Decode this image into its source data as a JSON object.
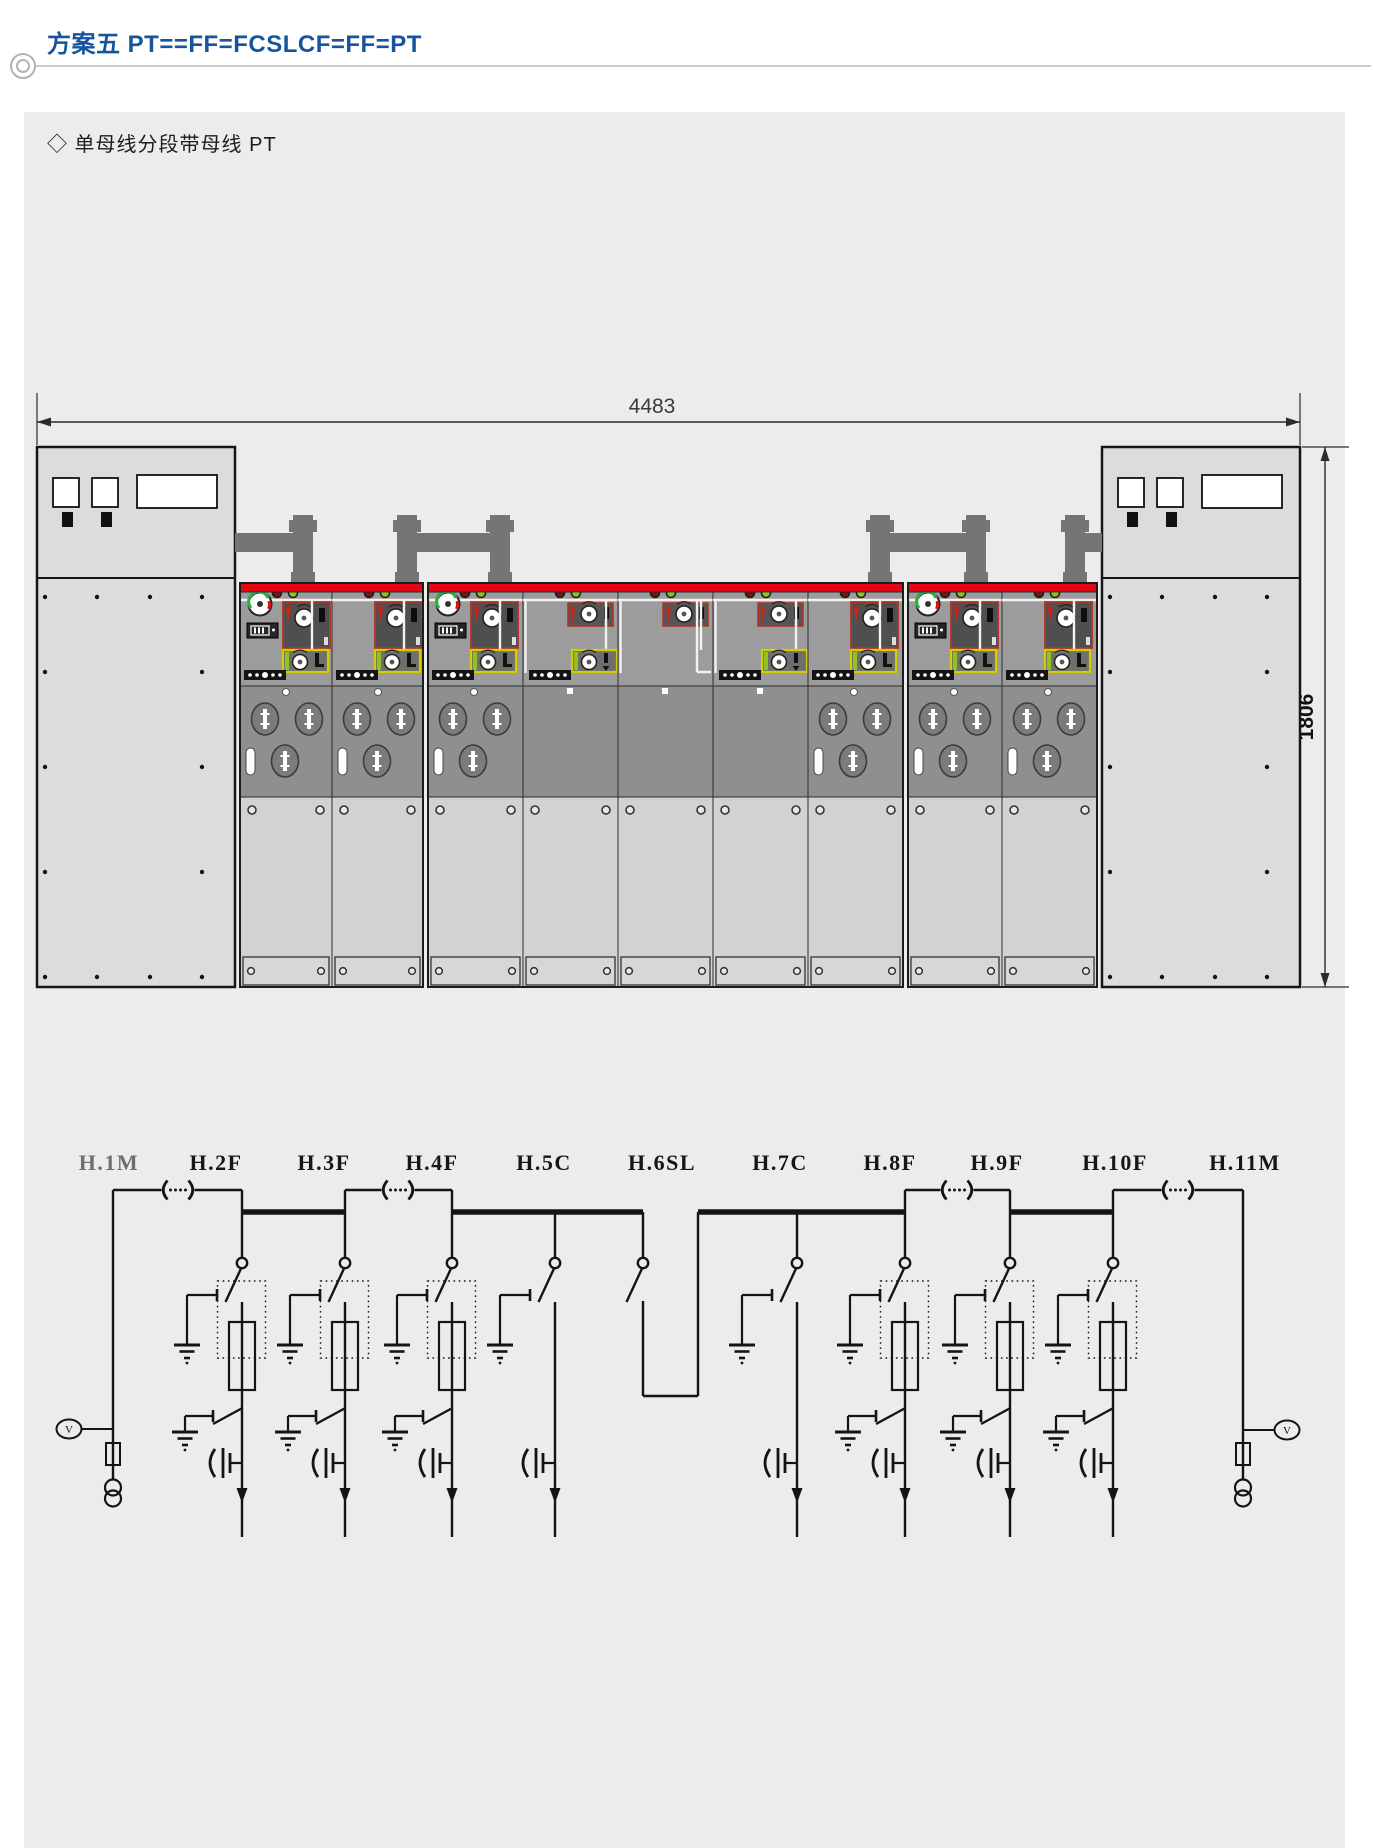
{
  "header": {
    "title": "方案五 PT==FF=FCSLCF=FF=PT"
  },
  "panel": {
    "subtitle": "◇ 单母线分段带母线 PT"
  },
  "colors": {
    "accent_blue": "#15559d",
    "red_stripe": "#e30613",
    "module_red_border": "#b23325",
    "yellow_border": "#d6cc00",
    "green_indicator": "#8fc31f",
    "panel_gray": "#9c9c9c",
    "line": "#1a1a1a",
    "pipe_gray": "#757575",
    "muted_label": "#6e6e6e"
  },
  "elevation": {
    "dim_width": "4483",
    "dim_height": "1806",
    "cabinets": [
      {
        "side": "left",
        "x": 37
      },
      {
        "side": "right",
        "x": 1102
      }
    ],
    "pipes": {
      "verticals": [
        303,
        407,
        500,
        880,
        976,
        1075
      ],
      "arms": [
        [
          235,
          304
        ],
        [
          407,
          501
        ],
        [
          880,
          977
        ],
        [
          1075,
          1102
        ]
      ]
    },
    "blocks": [
      {
        "x": 240,
        "panels": [
          {
            "feeder": "H.2F",
            "type": "F",
            "gauge": true,
            "w": 92
          },
          {
            "feeder": "H.3F",
            "type": "F",
            "gauge": false,
            "w": 91
          }
        ]
      },
      {
        "x": 428,
        "panels": [
          {
            "feeder": "H.4F",
            "type": "F",
            "gauge": true,
            "w": 95
          },
          {
            "feeder": "H.5C",
            "type": "C",
            "gauge": false,
            "w": 95
          },
          {
            "feeder": "H.6SL",
            "type": "SL",
            "gauge": false,
            "w": 95
          },
          {
            "feeder": "H.7C",
            "type": "C",
            "gauge": false,
            "w": 95
          },
          {
            "feeder": "H.8F",
            "type": "F",
            "gauge": false,
            "w": 95
          }
        ]
      },
      {
        "x": 908,
        "panels": [
          {
            "feeder": "H.9F",
            "type": "F",
            "gauge": true,
            "w": 94
          },
          {
            "feeder": "H.10F",
            "type": "F",
            "gauge": false,
            "w": 95
          }
        ]
      }
    ]
  },
  "schematic": {
    "meter_label": "V",
    "bus": {
      "thin": [
        {
          "x1": 113,
          "x2": 242,
          "cx": 178
        },
        {
          "x1": 345,
          "x2": 452,
          "cx": 398
        },
        {
          "x1": 905,
          "x2": 1010,
          "cx": 957
        },
        {
          "x1": 1113,
          "x2": 1243,
          "cx": 1178
        }
      ],
      "thick": [
        [
          242,
          345
        ],
        [
          452,
          643
        ],
        [
          698,
          905
        ],
        [
          1010,
          1113
        ]
      ],
      "sl_riser_x": 698
    },
    "feeders": [
      {
        "id": "H.1M",
        "type": "M",
        "x": 113,
        "label_x": 109,
        "muted": true,
        "side": "left"
      },
      {
        "id": "H.2F",
        "type": "F",
        "x": 242,
        "label_x": 216,
        "top": 1190
      },
      {
        "id": "H.3F",
        "type": "F",
        "x": 345,
        "label_x": 324,
        "top": 1190
      },
      {
        "id": "H.4F",
        "type": "F",
        "x": 452,
        "label_x": 432,
        "top": 1190
      },
      {
        "id": "H.5C",
        "type": "C",
        "x": 555,
        "label_x": 544,
        "top": 1212
      },
      {
        "id": "H.6SL",
        "type": "SL",
        "x": 643,
        "label_x": 662,
        "top": 1212
      },
      {
        "id": "H.7C",
        "type": "C",
        "x": 797,
        "label_x": 780,
        "top": 1212
      },
      {
        "id": "H.8F",
        "type": "F",
        "x": 905,
        "label_x": 890,
        "top": 1190
      },
      {
        "id": "H.9F",
        "type": "F",
        "x": 1010,
        "label_x": 997,
        "top": 1190
      },
      {
        "id": "H.10F",
        "type": "F",
        "x": 1113,
        "label_x": 1115,
        "top": 1190
      },
      {
        "id": "H.11M",
        "type": "M",
        "x": 1243,
        "label_x": 1245,
        "muted": false,
        "side": "right"
      }
    ]
  }
}
